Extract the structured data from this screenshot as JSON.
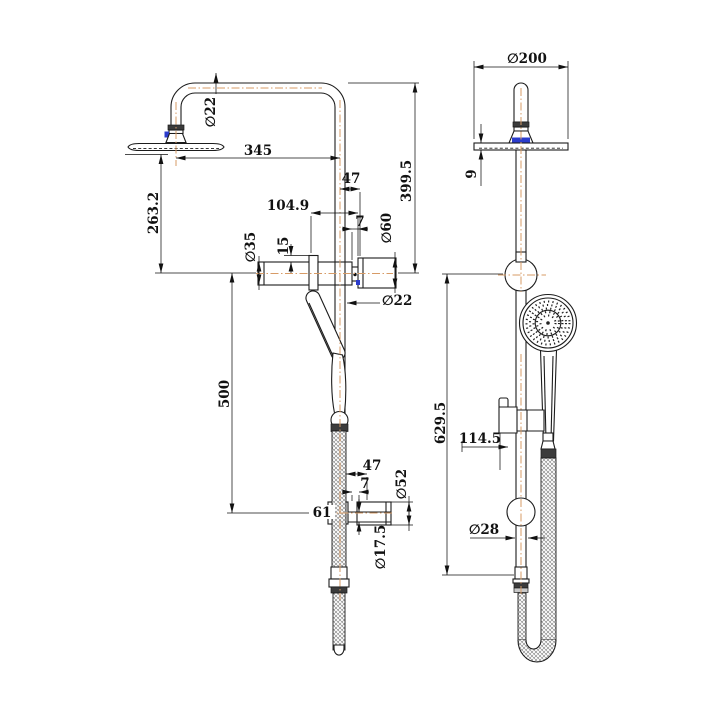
{
  "drawing_title": "shower column two-view dimension drawing",
  "colors": {
    "background": "#ffffff",
    "line": "#1c1c1c",
    "centerline": "#d79b66",
    "accent_blue": "#2b3ccc"
  },
  "views": {
    "left": {
      "name": "side view",
      "dims": {
        "dia22_top": "∅22",
        "len345": "345",
        "len47_top": "47",
        "len399_5": "399.5",
        "len263_2": "263.2",
        "len104_9": "104.9",
        "len7_top": "7",
        "dia35": "∅35",
        "len15": "15",
        "dia60": "∅60",
        "dia22_mid": "∅22",
        "len500": "500",
        "len61": "61",
        "len47_bot": "47",
        "len7_bot": "7",
        "dia52": "∅52",
        "dia17_5": "∅17.5"
      }
    },
    "right": {
      "name": "front view",
      "dims": {
        "dia200": "∅200",
        "len9": "9",
        "len629_5": "629.5",
        "len114_5": "114.5",
        "dia28": "∅28"
      }
    }
  }
}
